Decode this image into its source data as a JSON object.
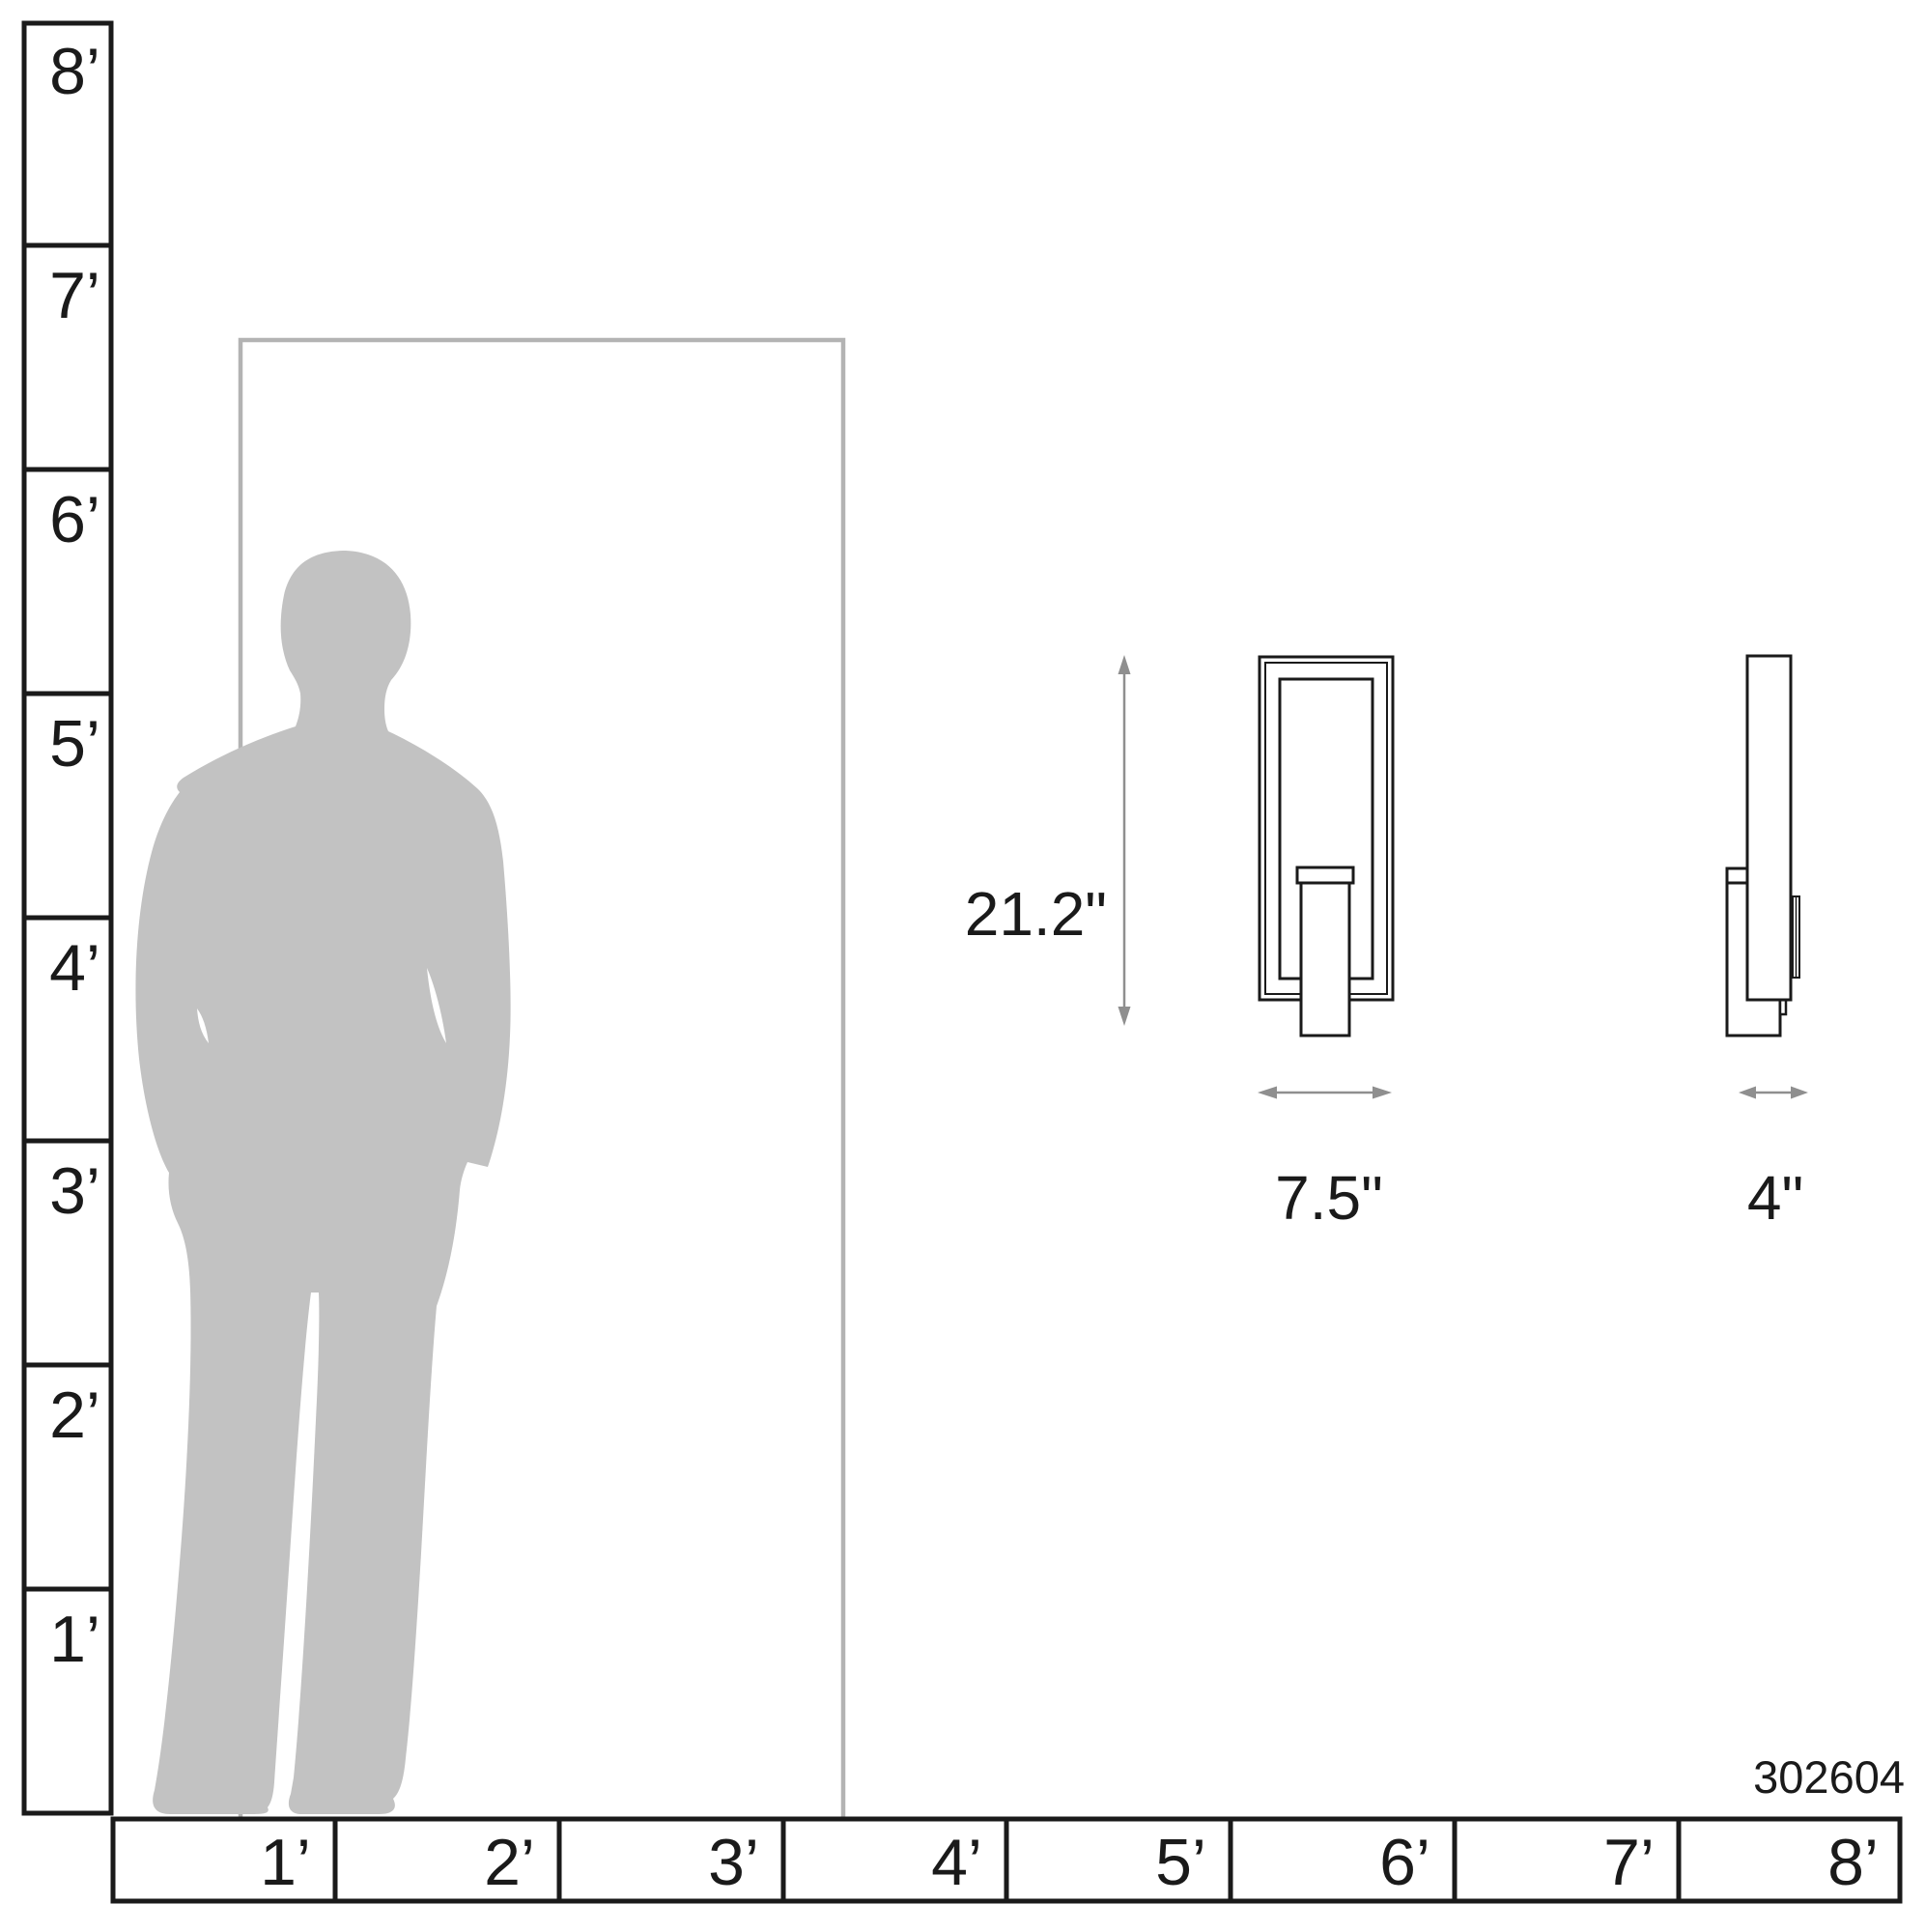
{
  "product_number": "302604",
  "rulers": {
    "left_labels": [
      "8’",
      "7’",
      "6’",
      "5’",
      "4’",
      "3’",
      "2’",
      "1’"
    ],
    "bottom_labels": [
      "1’",
      "2’",
      "3’",
      "4’",
      "5’",
      "6’",
      "7’",
      "8’"
    ],
    "unit": "feet"
  },
  "dimensions": {
    "height_label": "21.2\"",
    "width_label": "7.5\"",
    "depth_label": "4\""
  },
  "scene": {
    "description": "Wall sconce scale diagram: human silhouette beside door outline, front view and side view of fixture with dimension arrows"
  },
  "colors": {
    "line": "#1a1a1a",
    "silhouette": "#c2c2c2",
    "door_outline": "#b3b3b3",
    "dimension_arrow": "#8f8f8f",
    "background": "#ffffff"
  }
}
